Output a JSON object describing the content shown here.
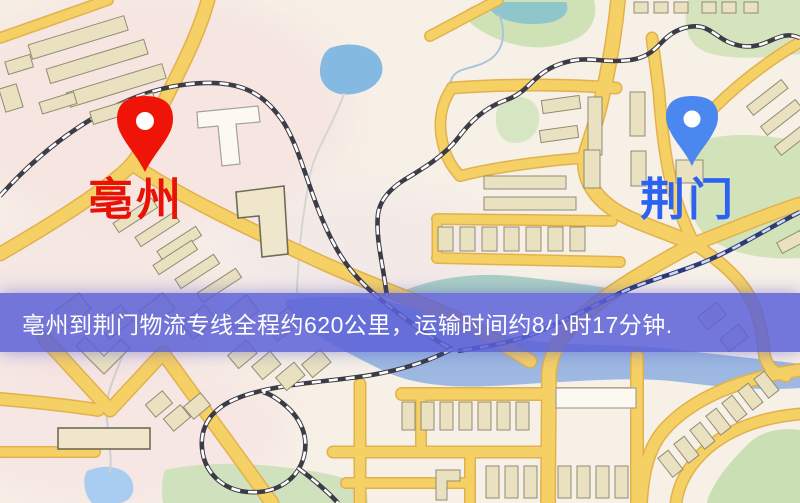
{
  "type": "logistics-route-map",
  "origin_marker": {
    "label": "亳州",
    "pin_color": "#f01308",
    "label_color": "#e81206"
  },
  "destination_marker": {
    "label": "荆门",
    "pin_color": "#4a87ef",
    "label_color": "#2b62f0"
  },
  "banner": {
    "text": "亳州到荆门物流专线全程约620公里，运输时间约8小时17分钟.",
    "background_color": "#5c60d7",
    "text_color": "#ffffff"
  },
  "route": {
    "distance_km": "620",
    "duration": "8小时17分钟"
  },
  "map_palette": {
    "background": "#f7f0e7",
    "road_fill": "#f5d065",
    "road_casing": "#e2b14e",
    "water": "#9db9e2",
    "park_green": "#cfe2b6",
    "building": "#eae1c1",
    "railway_dark": "#3c3c46"
  }
}
